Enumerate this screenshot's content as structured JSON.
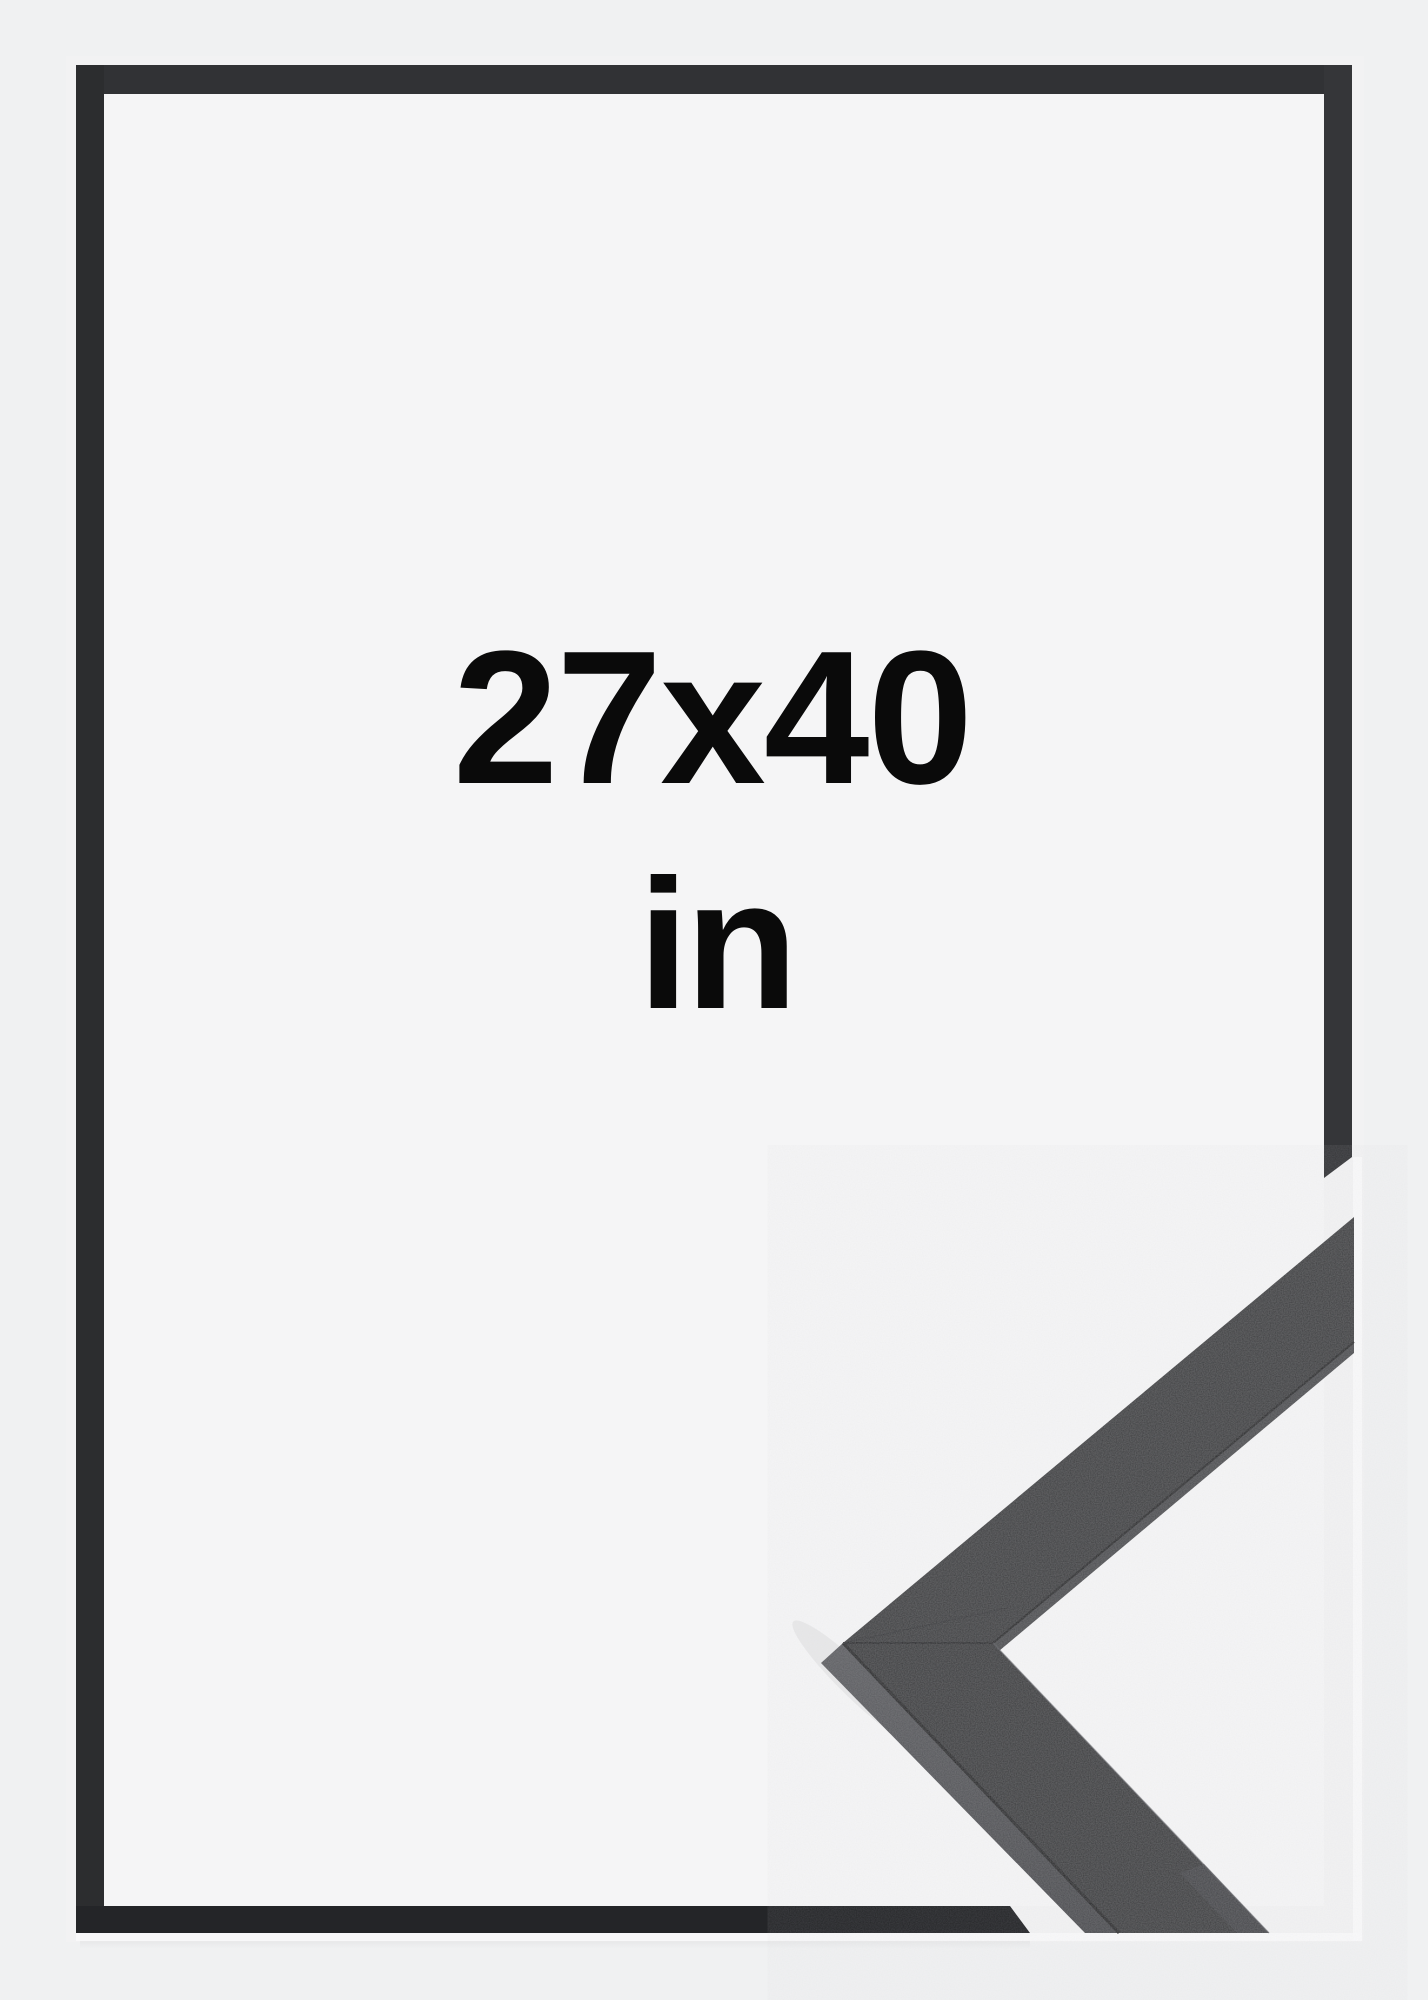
{
  "labels": {
    "size": "27x40",
    "unit": "in"
  },
  "colors": {
    "page_bg": "#f0f1f2",
    "canvas_bg": "#f2f2f3",
    "interior": "#f5f5f6",
    "frame_top": "#313235",
    "frame_left": "#2c2d2f",
    "frame_right": "#353639",
    "frame_bottom": "#242528",
    "sample_face_upper": "#3b3c3e",
    "sample_face_lower": "#393a3c",
    "sample_side": "#56575b",
    "sample_side_strip": "#4b4c4f",
    "sample_seam": "#1a1b1d",
    "sliver": "#fafafb",
    "text": "#0a0a0a"
  },
  "description": {
    "product": "black picture frame",
    "view": "front frame outline with corner moulding detail"
  }
}
